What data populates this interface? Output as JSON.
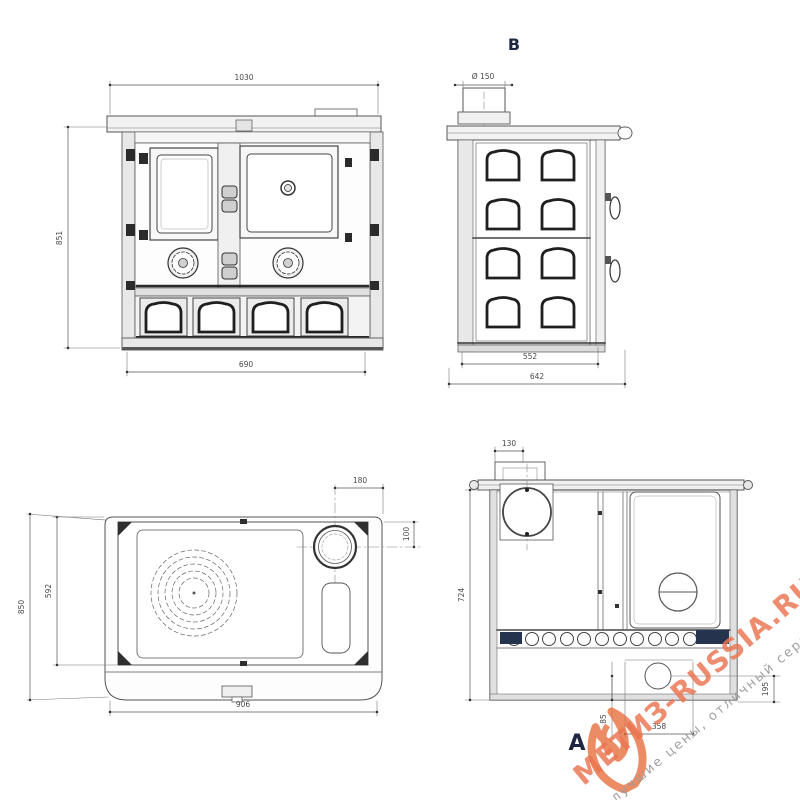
{
  "views": {
    "front": {
      "dims": {
        "width_top": "1030",
        "height_left": "851",
        "width_bottom": "690"
      }
    },
    "side": {
      "label": "B",
      "dims": {
        "flue_diameter": "Ø 150",
        "depth_inner": "552",
        "depth_outer": "642"
      }
    },
    "top": {
      "dims": {
        "flue_edge_offset": "180",
        "flue_center_offset": "100",
        "depth_outer": "850",
        "depth_inner": "592",
        "width_front": "906"
      }
    },
    "section": {
      "label": "A",
      "dims": {
        "flue_box_width": "130",
        "height_inner": "724",
        "outlet_height": "195",
        "outlet_distance": "358",
        "outlet_offset": "85"
      }
    }
  },
  "watermark": {
    "brand": "МЕТИЗ-RUSSIA.RU",
    "tagline": "лучшие цены, отличный сервис!",
    "brand_color": "#ea7450",
    "tagline_color": "#9b9b9b"
  },
  "colors": {
    "line": "#4a4a4a",
    "dark_detail": "#2b2b2b",
    "label_blue": "#1d2742"
  }
}
